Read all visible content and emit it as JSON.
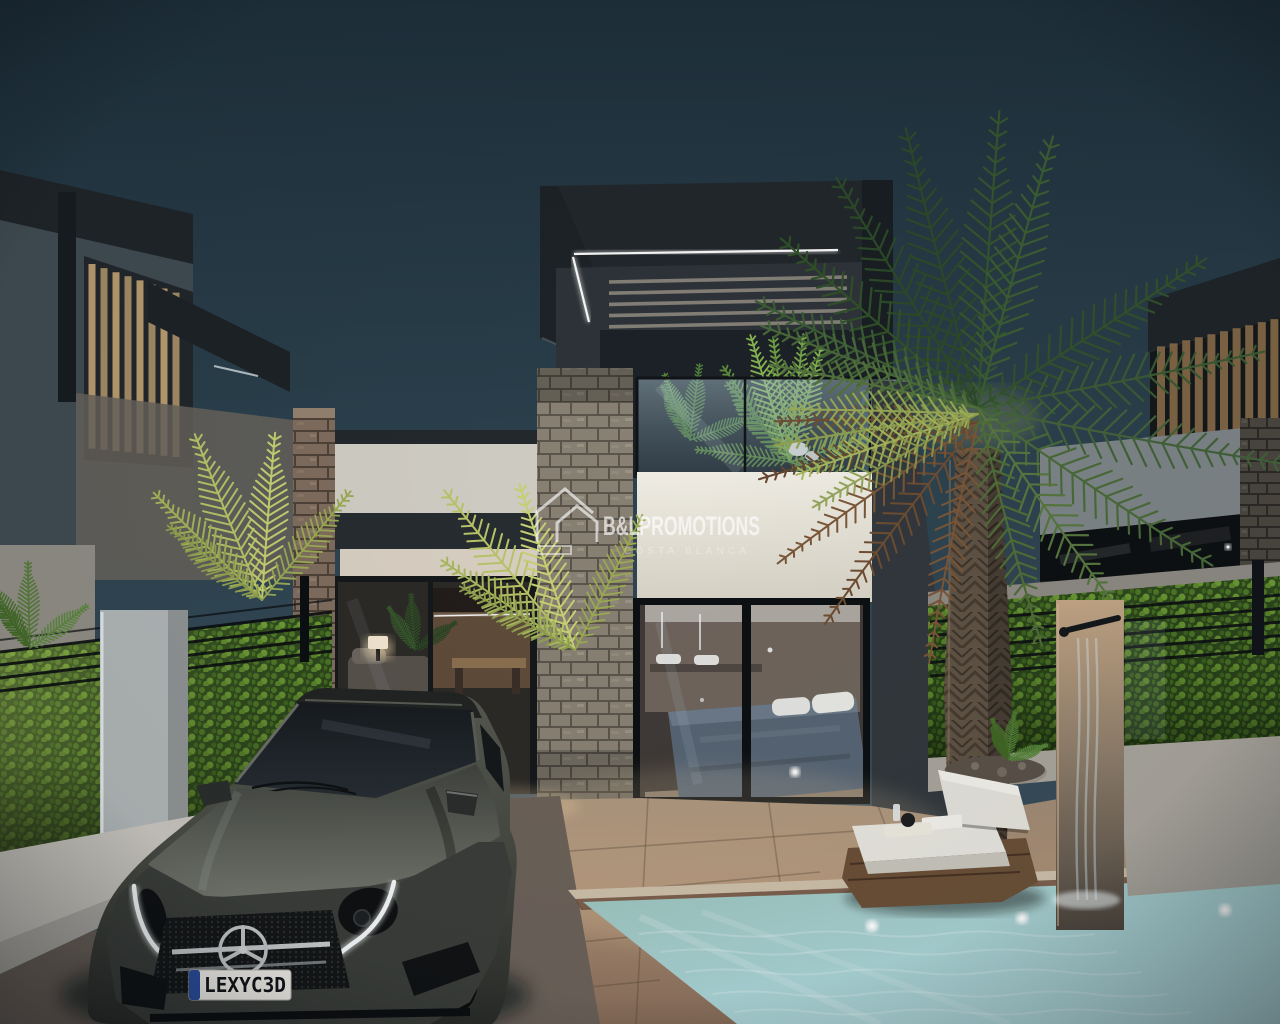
{
  "scene": {
    "kind": "3d-architectural-render",
    "time_of_day": "dusk",
    "objects": [
      "modern-villa",
      "neighbor-villa-left",
      "neighbor-villa-right",
      "palm-tree",
      "driveway-car",
      "swimming-pool",
      "sun-lounger",
      "garden-shower",
      "hedge-fence",
      "stone-columns",
      "lit-bedroom-interior",
      "lit-living-interior"
    ]
  },
  "watermark": {
    "title": "B&LPROMOTIONS",
    "subtitle": "COSTA BLANCA",
    "icon": "twin-peak-house-logo-icon"
  },
  "car": {
    "license_plate": "LEXYC3D",
    "emblem": "mercedes-star-icon"
  },
  "palette": {
    "sky_top": "#1e2f3a",
    "sky_bottom": "#3e5360",
    "canopy_charcoal": "#22272c",
    "wall_white": "#e7e4db",
    "stone_gray": "#878073",
    "wood_slat": "#c2a273",
    "hedge_green": "#5d8a2d",
    "pool_water": "#a5d0cf",
    "led_white": "#ffffff",
    "car_gray": "#4b4e47",
    "plate_blue": "#2b4fa0",
    "floor_terracotta": "#ab8f75"
  }
}
